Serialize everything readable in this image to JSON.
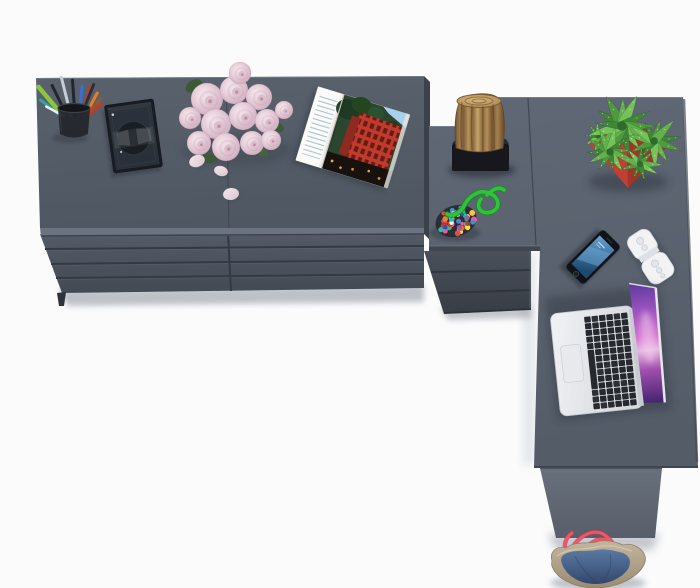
{
  "scene": {
    "kind": "furniture-product-photo",
    "view": "top-down",
    "background_color": "#fbfbfc",
    "description": "Anthracite grey L-shaped corner desk with a 3-drawer return unit joined to a wide 8-drawer double dresser, seen from directly above, styled with desk accessories"
  },
  "furniture": {
    "surface_color": "#5c6471",
    "dresser_top_color": "#57606c",
    "drawer_face_top": "#545b67",
    "drawer_face_bottom": "#434a54",
    "drawer_gap_color": "#343a44",
    "edge_color": "#3b414b",
    "pieces": [
      {
        "name": "double-dresser",
        "drawer_columns": 2,
        "drawer_rows": 4
      },
      {
        "name": "desk-return-drawer-unit",
        "drawers": 3
      },
      {
        "name": "corner-desk",
        "support": "side-panel-leg"
      }
    ]
  },
  "objects": {
    "pencil_cup": {
      "cup_color": "#24272d",
      "pens": [
        [
          63,
          -40,
          38,
          "#8cc63e",
          4.5
        ],
        [
          67,
          -26,
          34,
          "#23262b",
          3
        ],
        [
          71,
          -14,
          40,
          "#c9ced6",
          3
        ],
        [
          75,
          -4,
          36,
          "#23262b",
          3
        ],
        [
          79,
          6,
          30,
          "#3a6fd0",
          3
        ],
        [
          61,
          -52,
          26,
          "#2fa99b",
          3
        ],
        [
          82,
          16,
          30,
          "#c0392b",
          3
        ],
        [
          85,
          28,
          26,
          "#e67e22",
          3
        ],
        [
          87,
          38,
          22,
          "#8a5a3a",
          3.5
        ],
        [
          88,
          48,
          18,
          "#c0392b",
          3
        ],
        [
          64,
          -62,
          20,
          "#eef0f2",
          2.5
        ],
        [
          81,
          22,
          34,
          "#2c2f35",
          3
        ]
      ]
    },
    "photo_frame": {
      "glass_color": "rgba(22,26,33,0.52)",
      "border_color": "#181b21"
    },
    "roses": {
      "bloom_color": "#e7d2dc",
      "leaf_color": "#3c5a38",
      "blooms": [
        [
          207,
          99,
          16
        ],
        [
          234,
          90,
          14
        ],
        [
          259,
          97,
          13
        ],
        [
          216,
          124,
          15
        ],
        [
          243,
          116,
          14
        ],
        [
          267,
          121,
          12
        ],
        [
          199,
          143,
          12
        ],
        [
          226,
          147,
          14
        ],
        [
          252,
          143,
          12
        ],
        [
          271,
          140,
          10
        ],
        [
          240,
          73,
          11
        ],
        [
          190,
          118,
          11
        ],
        [
          284,
          110,
          9
        ]
      ],
      "petals": [
        [
          197,
          161,
          8,
          6,
          -20
        ],
        [
          221,
          171,
          7,
          5,
          15
        ],
        [
          231,
          194,
          8,
          6,
          -8
        ]
      ]
    },
    "magazine": {
      "page_color": "#f5f4f0",
      "photo_subject": "red building among dark trees",
      "accent_color": "#c23a2c"
    },
    "stump": {
      "wood_light": "#c9a468",
      "wood_dark": "#6e5233",
      "base_color": "#16181d"
    },
    "beads": {
      "pouch_color": "#2b2e35",
      "cord_color": "#32c13c",
      "bead_count": 46,
      "bead_palette": [
        "#e74c3c",
        "#f6c644",
        "#3b8fd4",
        "#34c06a",
        "#ee7f2d",
        "#f4f4f4",
        "#9b59b6",
        "#ee5a93",
        "#27bfa8",
        "#c0392b",
        "#2954c8",
        "#f2ea3a"
      ]
    },
    "plant": {
      "pot_color": "#c04034",
      "leaf_palette": [
        "#3f8636",
        "#4e9a3f",
        "#63b04c",
        "#74c35a"
      ],
      "rosettes": [
        [
          598,
          136,
          18,
          8
        ],
        [
          622,
          126,
          34,
          13
        ],
        [
          654,
          141,
          28,
          11
        ],
        [
          610,
          152,
          26,
          11
        ],
        [
          640,
          164,
          22,
          9
        ]
      ]
    },
    "phone": {
      "body_color": "#0f1216",
      "screen_top": "#6aa3cc",
      "screen_bottom": "#1f4a70"
    },
    "remote": {
      "body_color": "#f3f3f5",
      "button_color": "#e4e6ea"
    },
    "laptop": {
      "body_color": "#e9ebee",
      "key_color": "#26292e",
      "keyboard": {
        "cols": 6,
        "rows": 14
      },
      "screen_colors": [
        "#5d3a9e",
        "#a055c0",
        "#d96fd0",
        "#41246e"
      ]
    },
    "bag": {
      "body_color": "#b7a88f",
      "panel_color": "#46618a",
      "strap_color": "#ef5668"
    }
  }
}
